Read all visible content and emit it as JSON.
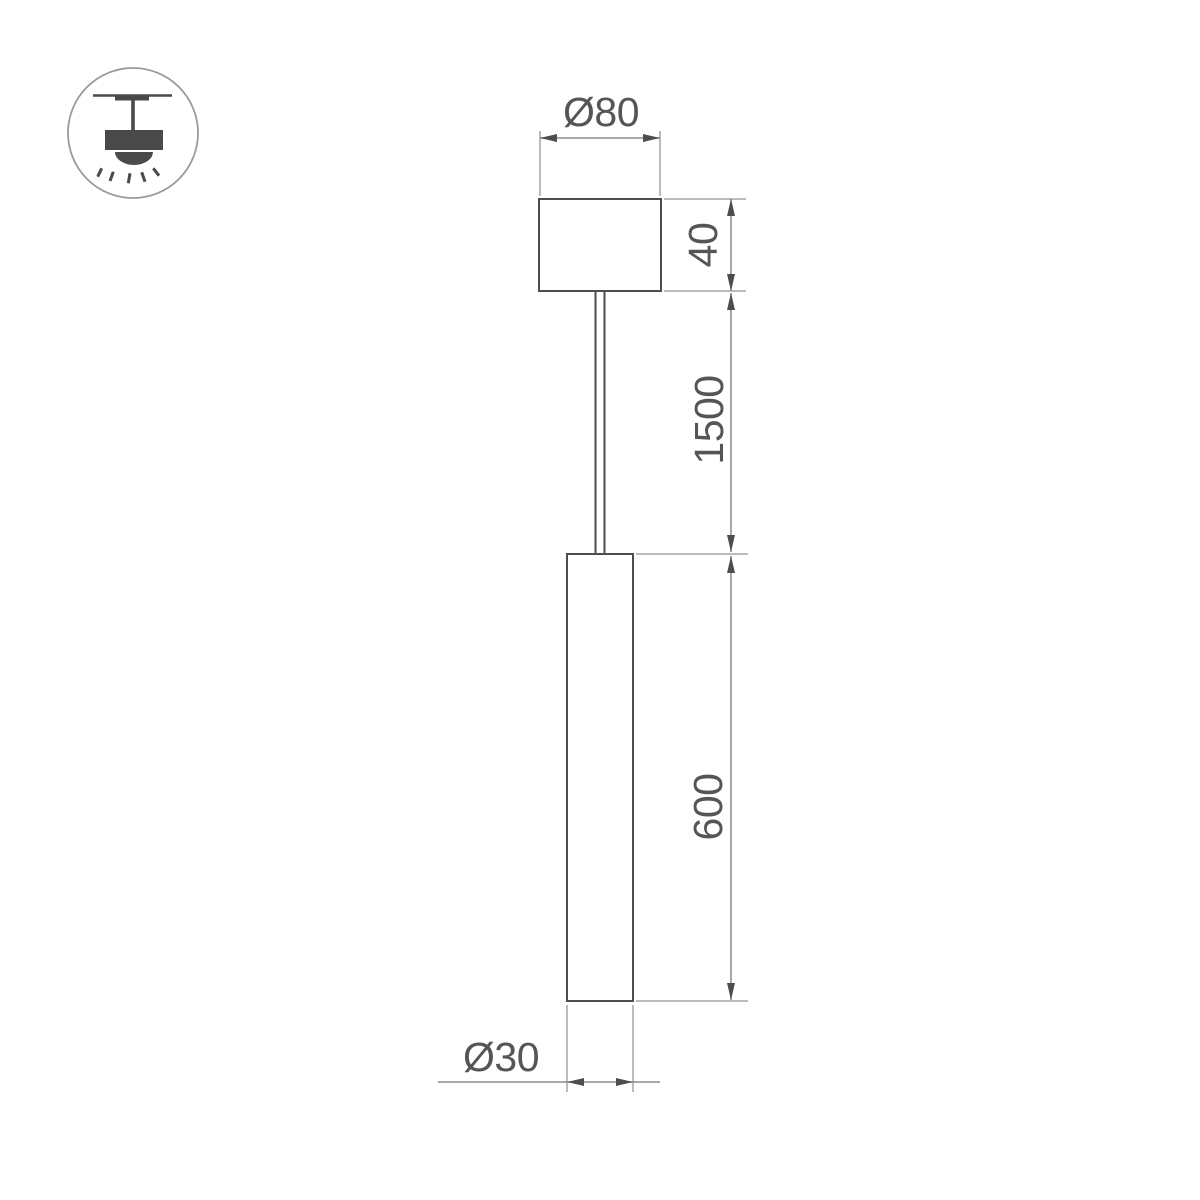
{
  "page": {
    "kind": "product-dimension-drawing",
    "object": "LED pendant lamp (tube on suspension cable with ceiling canopy)"
  },
  "icon_badge": {
    "name": "pendant-ceiling-light-icon",
    "meaning": "suspended / pendant mounting type"
  },
  "drawing": {
    "dimensions": {
      "canopy_diameter": "Ø80",
      "canopy_height": "40",
      "suspension_length": "1500",
      "tube_length": "600",
      "tube_diameter": "Ø30"
    },
    "colors": {
      "object_line": "#4d4d4d",
      "dimension_line": "#8a8a8a",
      "extension_line": "#a6a6a6",
      "text": "#555555",
      "icon_fill": "#4a4a4a",
      "icon_circle": "#9a9a9a",
      "background": "#ffffff"
    }
  }
}
